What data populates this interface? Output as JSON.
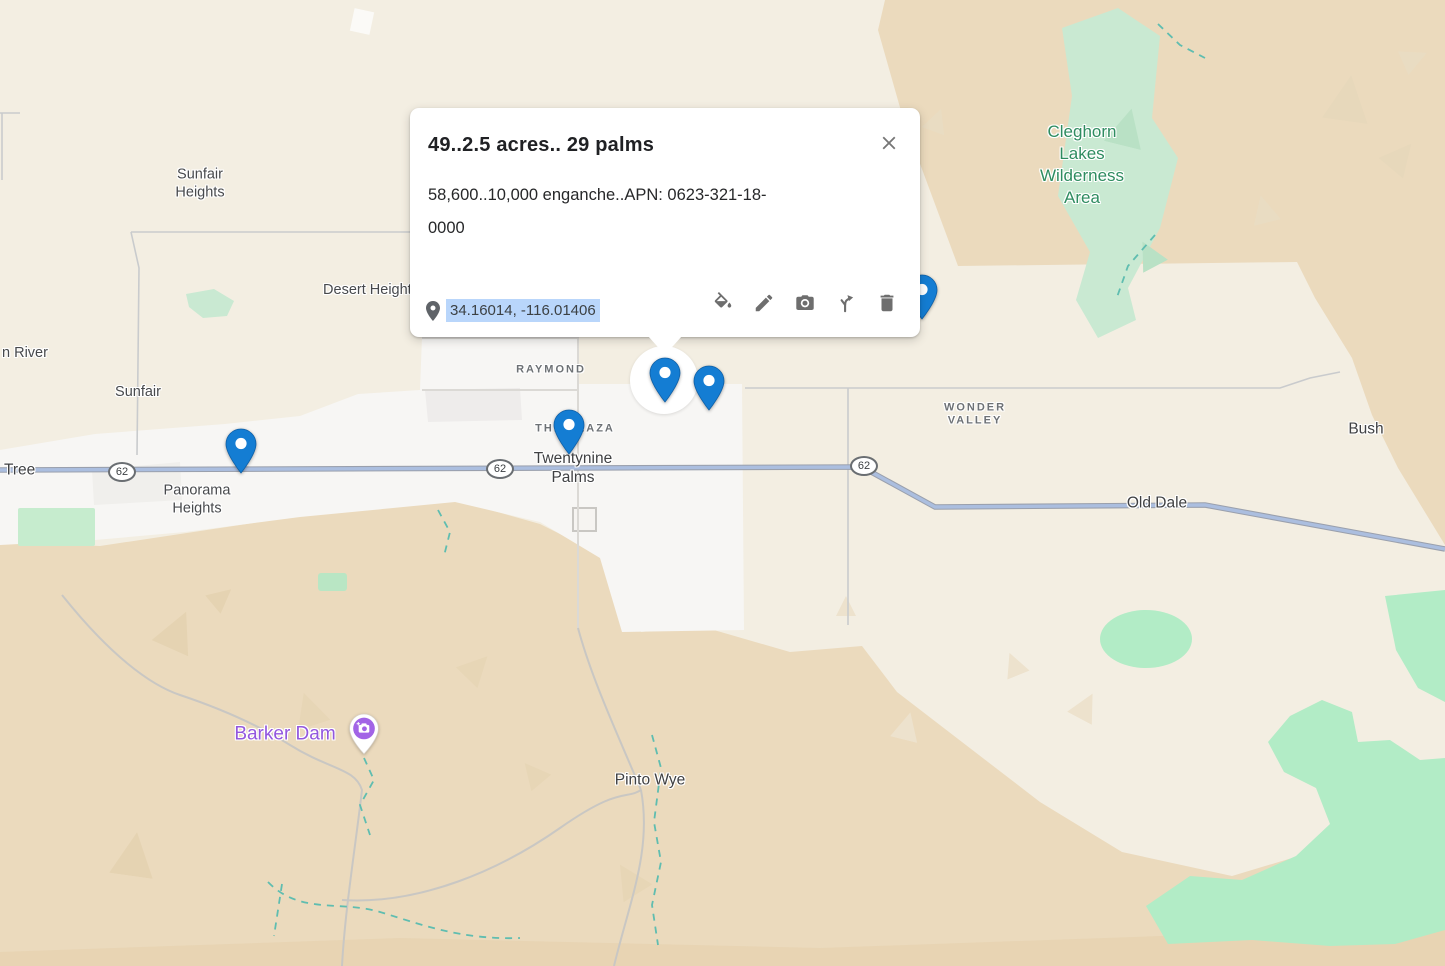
{
  "popup": {
    "title": "49..2.5 acres.. 29 palms",
    "body_line1": "58,600..10,000 enganche..APN: 0623-321-18-",
    "body_line2": "0000",
    "coordinates": "34.16014, -116.01406",
    "actions": [
      "style",
      "edit",
      "photo",
      "directions",
      "delete"
    ]
  },
  "map": {
    "labels": [
      {
        "id": "sunfair-heights",
        "text": "Sunfair\nHeights"
      },
      {
        "id": "desert-heights",
        "text": "Desert Heights"
      },
      {
        "id": "river",
        "text": "n River"
      },
      {
        "id": "sunfair",
        "text": "Sunfair"
      },
      {
        "id": "raymond",
        "text": "RAYMOND"
      },
      {
        "id": "the-plaza",
        "text": "THE PLAZA"
      },
      {
        "id": "twentynine-palms",
        "text": "Twentynine\nPalms"
      },
      {
        "id": "wonder-valley",
        "text": "WONDER\nVALLEY"
      },
      {
        "id": "bush",
        "text": "Bush"
      },
      {
        "id": "old-dale",
        "text": "Old Dale"
      },
      {
        "id": "tree",
        "text": "Tree"
      },
      {
        "id": "panorama-heights",
        "text": "Panorama\nHeights"
      },
      {
        "id": "barker-dam",
        "text": "Barker Dam"
      },
      {
        "id": "pinto-wye",
        "text": "Pinto Wye"
      },
      {
        "id": "cleghorn",
        "text": "Cleghorn\nLakes\nWilderness\nArea"
      }
    ],
    "route_shields": [
      "62",
      "62",
      "62"
    ],
    "colors": {
      "marker_blue": "#147dd3",
      "selection_highlight": "#b9d6fb",
      "park_fill": "#c9e9d2",
      "park_label_green": "#2e8c60",
      "poi_purple": "#a264e6",
      "poi_label_purple": "#9357de",
      "highway_fill": "#abbedf",
      "desert_tan": "#ebdabd",
      "background_beige": "#f3eee2",
      "urban_white": "#f7f6f4"
    }
  }
}
